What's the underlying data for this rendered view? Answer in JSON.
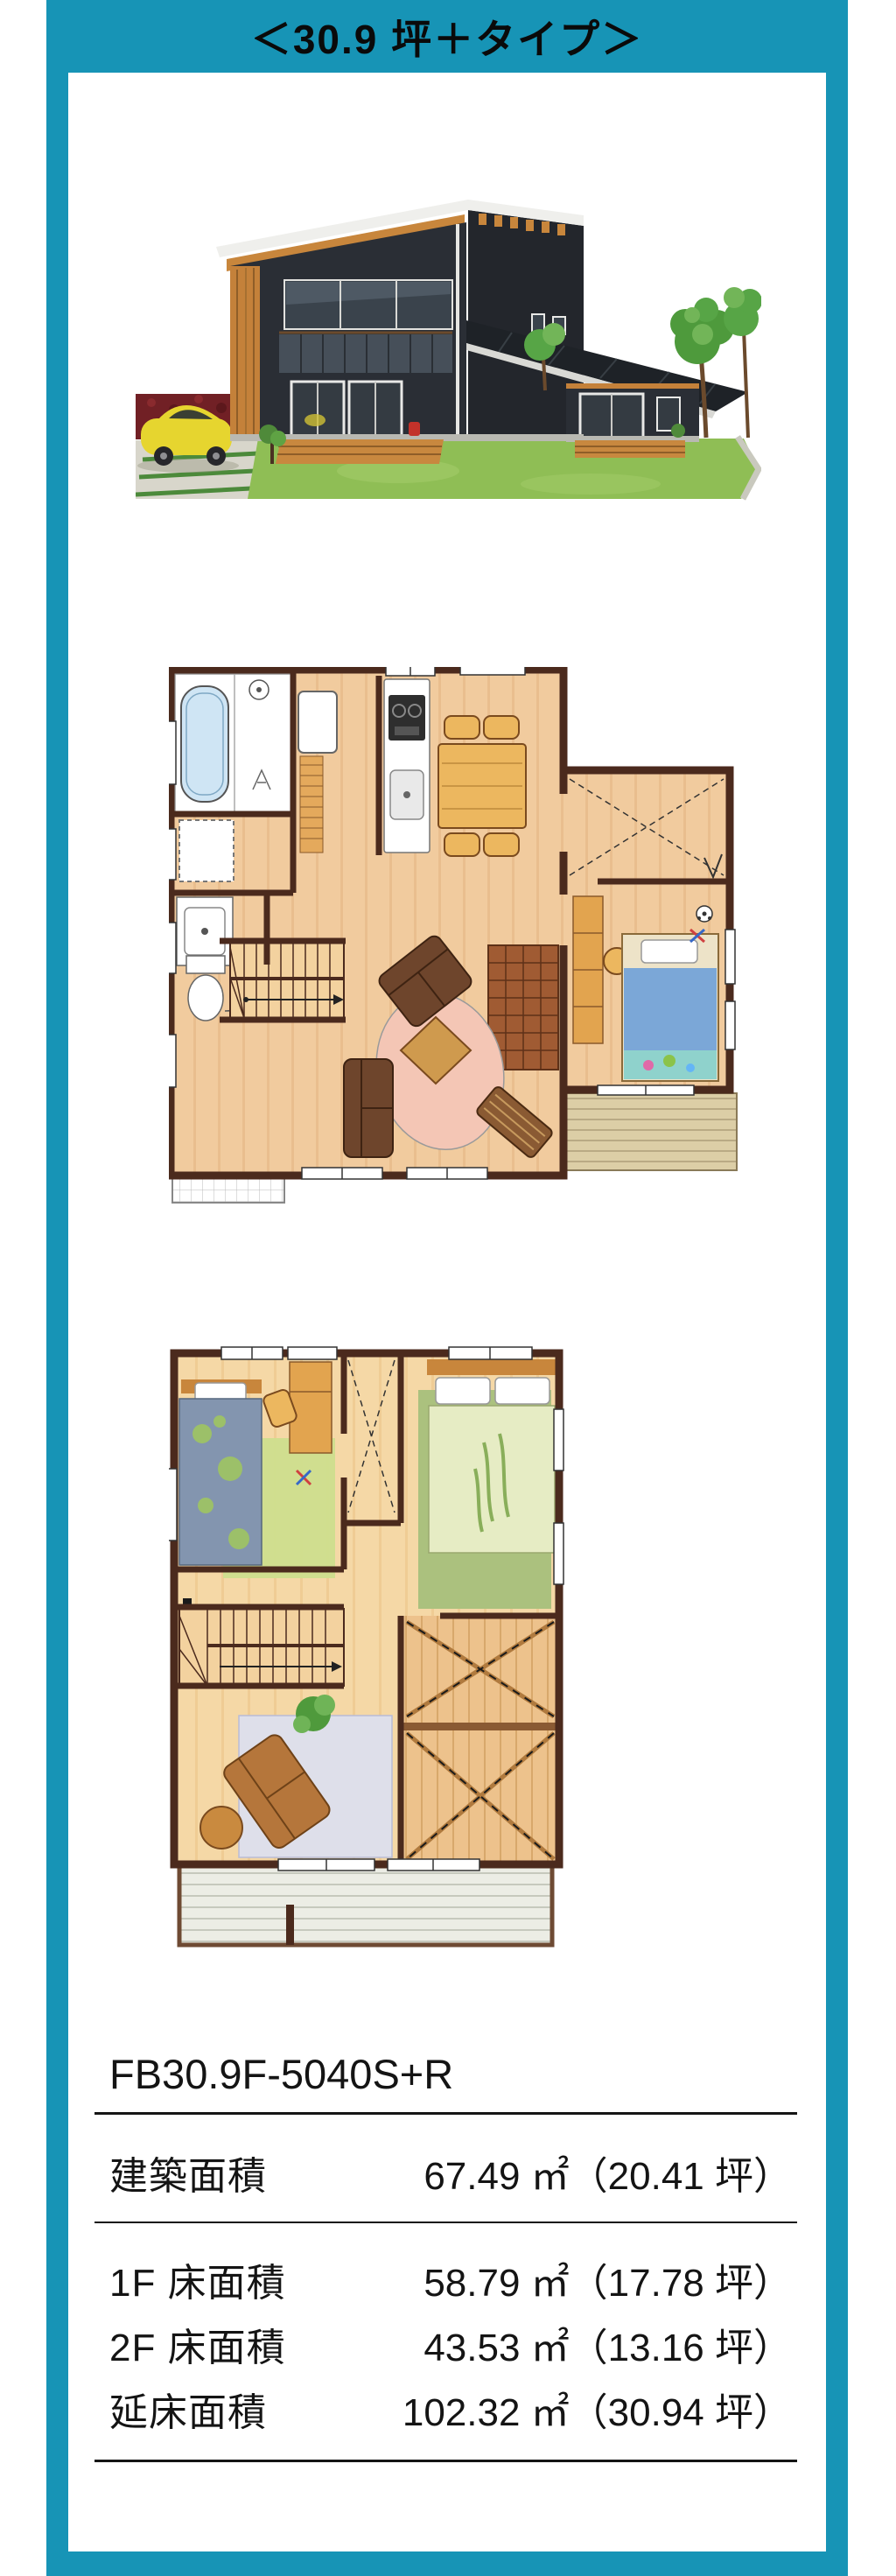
{
  "header": {
    "title": "＜30.9 坪＋タイプ＞"
  },
  "model": {
    "name": "FB30.9F-5040S+R"
  },
  "specs": {
    "rows": [
      {
        "label": "建築面積",
        "value": "67.49 ㎡（20.41 坪）"
      },
      {
        "label": "1F 床面積",
        "value": "58.79 ㎡（17.78 坪）"
      },
      {
        "label": "2F 床面積",
        "value": "43.53 ㎡（13.16 坪）"
      },
      {
        "label": "延床面積",
        "value": "102.32 ㎡（30.94 坪）"
      }
    ]
  },
  "figures": {
    "exterior": "house-exterior-rendering",
    "plan1f": "1f-floor-plan",
    "plan2f": "2f-floor-plan"
  },
  "palette": {
    "accent_teal": "#1794B6",
    "text": "#141414",
    "wall_brown": "#4B2A1D",
    "floor_1f": "#F1CB9E",
    "floor_2f": "#F5D8A6",
    "deck_tan": "#DCCEA6",
    "tatami_brown": "#A05B33",
    "rug_pink": "#F4C6B5",
    "rug_green": "#CDDE8D",
    "rug_lavender": "#DEDFEC",
    "bed_blue": "#7BA7D7",
    "bed_green": "#E6ECC4",
    "wood_orange": "#E2A44F",
    "lawn_green": "#8FBE55",
    "car_yellow": "#E6D52F"
  }
}
